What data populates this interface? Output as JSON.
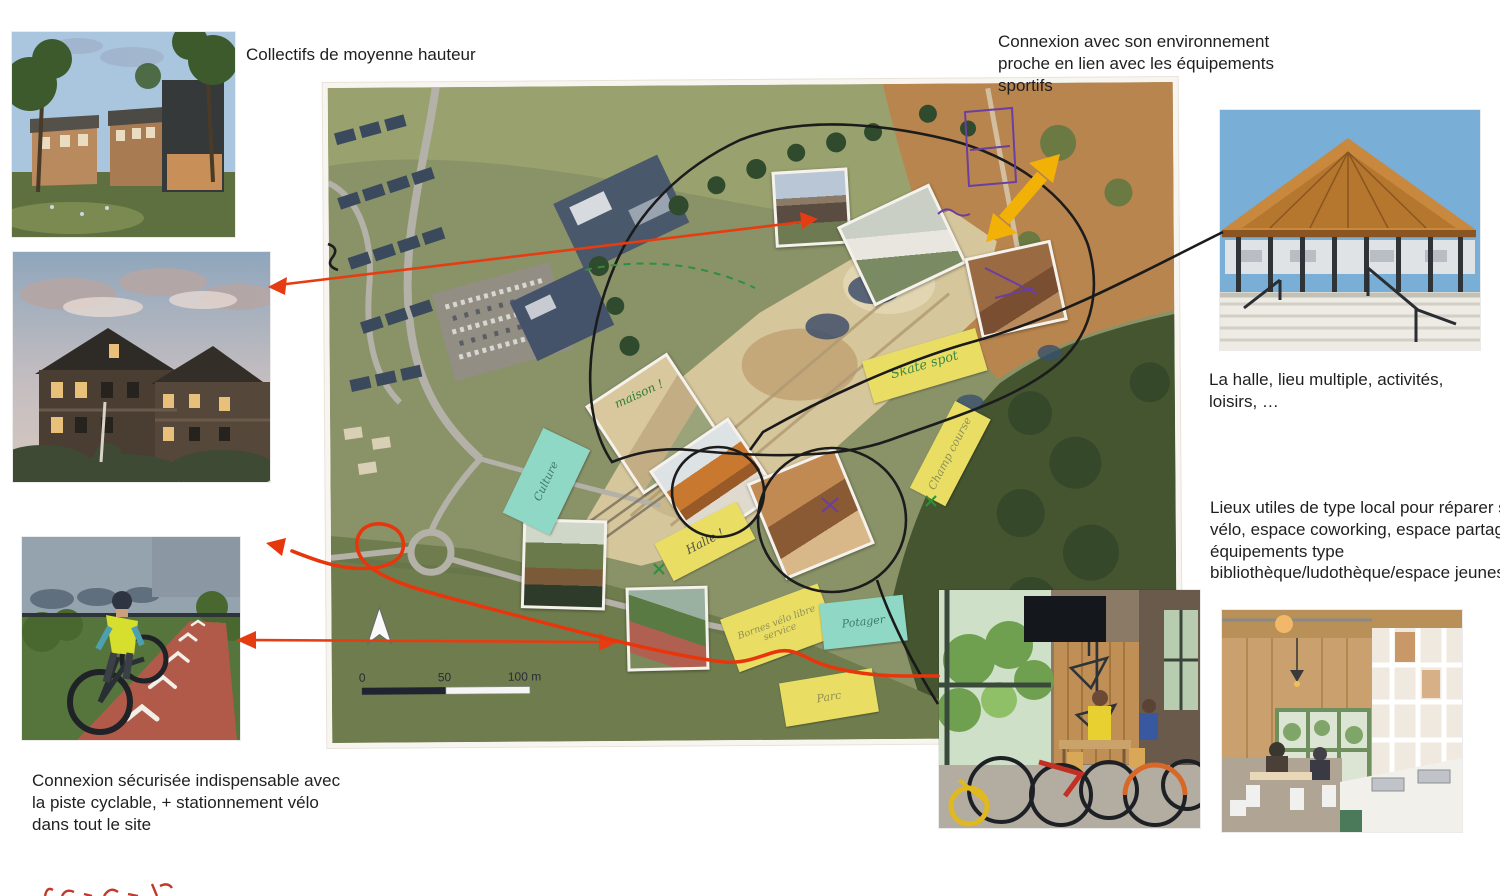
{
  "captions": {
    "collectifs": "Collectifs de moyenne hauteur",
    "connexion_environnement": "Connexion avec son environnement proche en lien avec les équipements sportifs",
    "halle": "La halle, lieu multiple, activités, loisirs, …",
    "lieux_utiles": "Lieux utiles de type local pour réparer son vélo, espace coworking, espace partagé, équipements type bibliothèque/ludothèque/espace jeunes…",
    "connexion_cyclable": "Connexion sécurisée indispensable avec la piste cyclable, + stationnement vélo dans tout le site"
  },
  "map": {
    "scale_labels": [
      "0",
      "50",
      "100 m"
    ],
    "sticky_notes": [
      {
        "label": "Skate spot",
        "color": "#e9de63",
        "ink": "#3f8a46"
      },
      {
        "label": "Champ course",
        "color": "#e9de63",
        "ink": "#8f8f58"
      },
      {
        "label": "Halle !",
        "color": "#e9de63",
        "ink": "#55554a"
      },
      {
        "label": "Bornes vélo libre service",
        "color": "#e9de63",
        "ink": "#8f8f58"
      },
      {
        "label": "Culture",
        "color": "#8fd8c6",
        "ink": "#3f7a6a"
      },
      {
        "label": "Potager",
        "color": "#8fd8c6",
        "ink": "#3f7a6a"
      },
      {
        "label": "Parc",
        "color": "#e9de63",
        "ink": "#8f8f58"
      }
    ],
    "handwriting_notes": [
      {
        "label": "maison !",
        "ink": "#2e7d32"
      }
    ]
  },
  "colors": {
    "red_annotation": "#e63c12",
    "black_annotation": "#1c1c1c",
    "yellow_arrow": "#f2b107",
    "purple_ink": "#6a3fa0",
    "sticky_yellow": "#e9de63",
    "sticky_teal": "#8fd8c6"
  }
}
